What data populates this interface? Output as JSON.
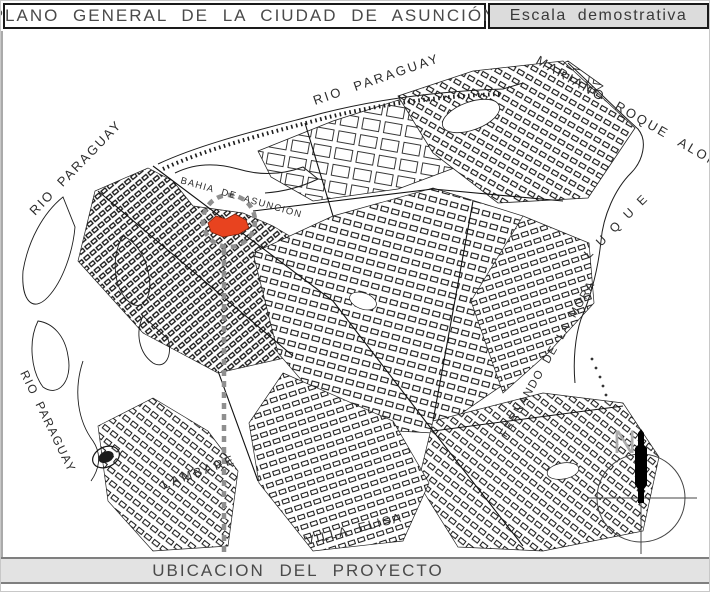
{
  "header": {
    "title": "PLANO GENERAL DE LA CIUDAD DE ASUNCIÓN",
    "scale_note": "Escala demostrativa"
  },
  "footer": {
    "label": "UBICACION DEL PROYECTO"
  },
  "map": {
    "labels": {
      "rio_paraguay_top": "RIO PARAGUAY",
      "rio_paraguay_upper_left": "RIO PARAGUAY",
      "rio_paraguay_lower_left": "RIO PARAGUAY",
      "mariano_roque_alonso": "MARIANO ROQUE ALONSO",
      "luque": "LUQUE",
      "bahia_de_asuncion": "BAHIA DE ASUNCION",
      "fernando_de_la_mora": "FERNANDO DE LA MORA",
      "lambare": "LAMBARE",
      "villa_elisa": "VILLA ELISA"
    },
    "compass": {
      "north_label": "N"
    },
    "colors": {
      "project_highlight": "#E8431F",
      "marker_gray": "#8F8F8F",
      "panel_gray": "#DCDCDC",
      "footer_gray": "#E3E3E3",
      "line_black": "#141414"
    }
  }
}
